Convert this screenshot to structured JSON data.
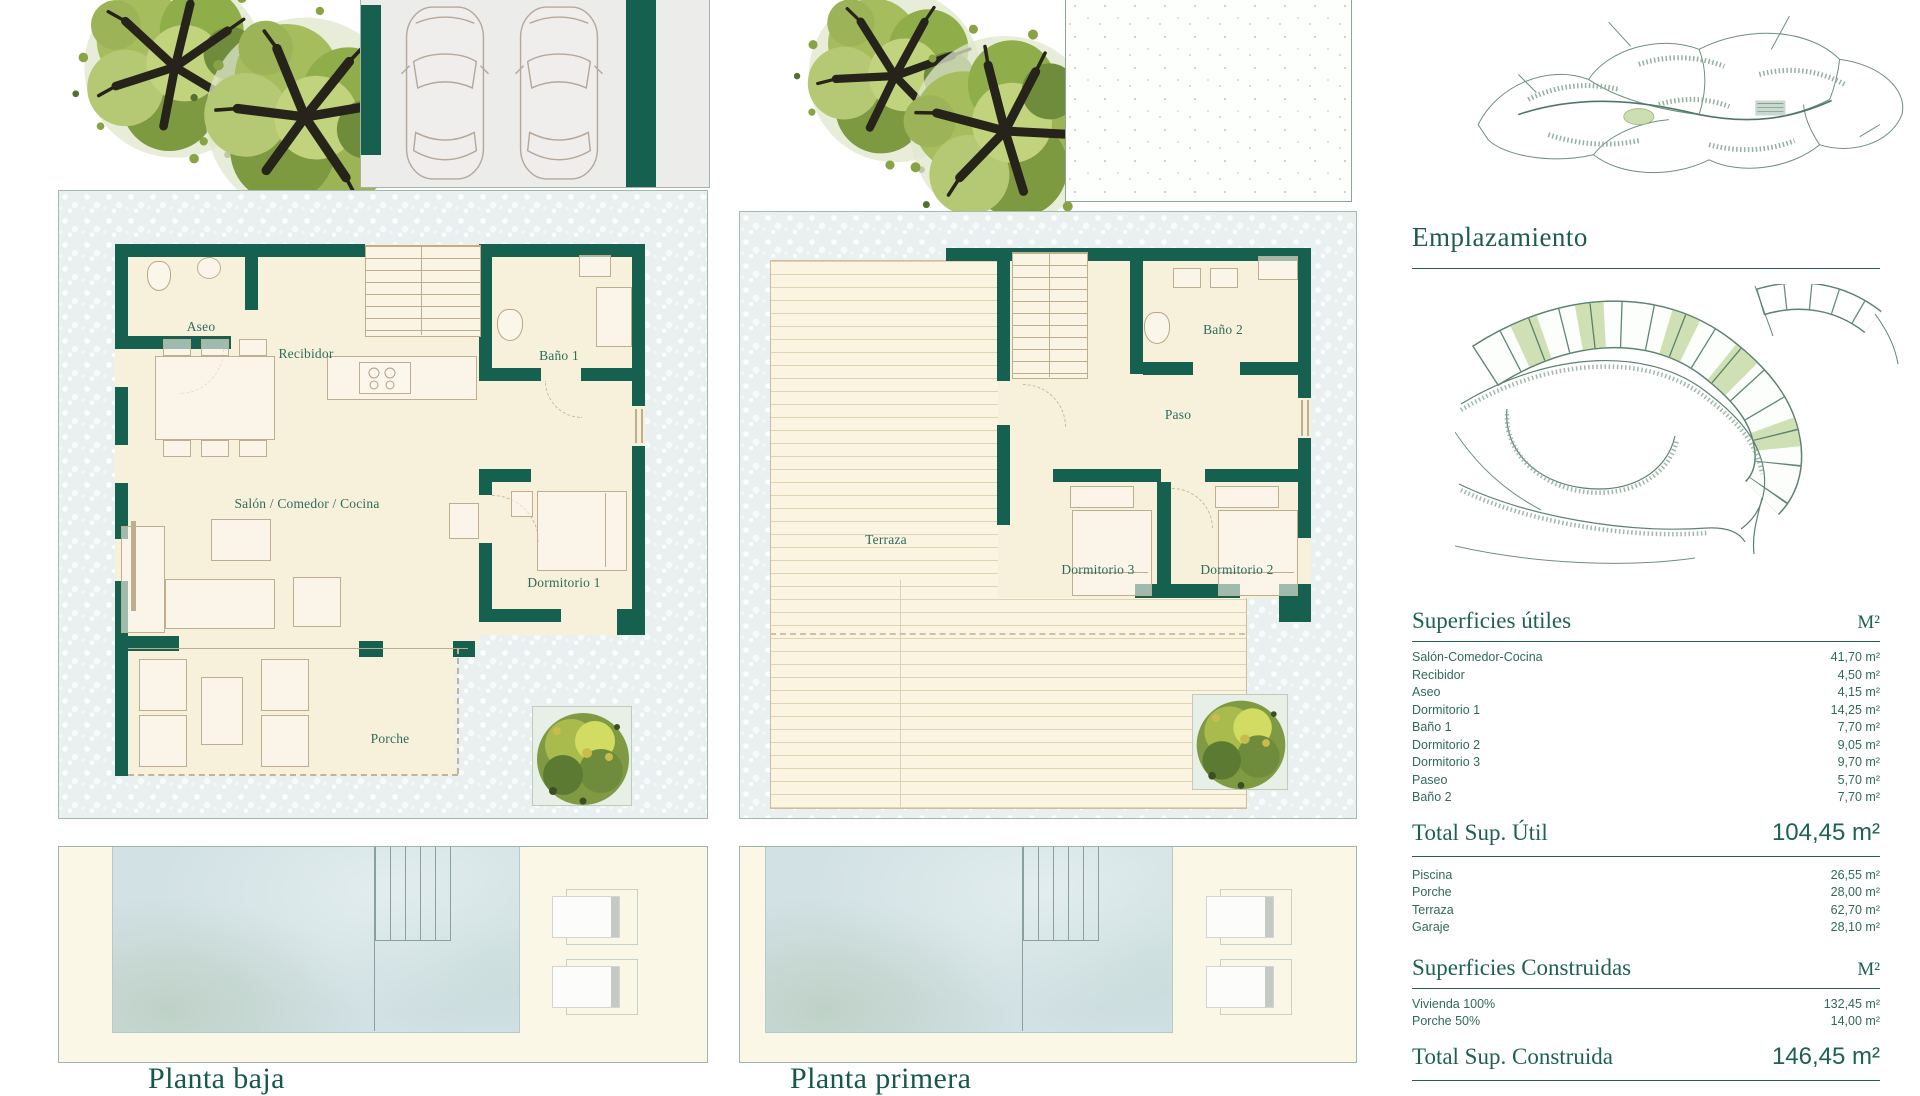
{
  "plans": {
    "ground": {
      "title": "Planta baja",
      "labels": {
        "aseo": "Aseo",
        "recibidor": "Recibidor",
        "bano1": "Baño 1",
        "salon": "Salón / Comedor / Cocina",
        "dormitorio1": "Dormitorio 1",
        "porche": "Porche"
      }
    },
    "upper": {
      "title": "Planta primera",
      "labels": {
        "terraza": "Terraza",
        "bano2": "Baño 2",
        "paso": "Paso",
        "dormitorio3": "Dormitorio 3",
        "dormitorio2": "Dormitorio 2"
      }
    }
  },
  "location": {
    "title": "Emplazamiento"
  },
  "surfaces": {
    "useful": {
      "title": "Superficies útiles",
      "unit": "M²",
      "rows": [
        {
          "label": "Salón-Comedor-Cocina",
          "value": "41,70 m²"
        },
        {
          "label": "Recibidor",
          "value": "4,50 m²"
        },
        {
          "label": "Aseo",
          "value": "4,15 m²"
        },
        {
          "label": "Dormitorio 1",
          "value": "14,25 m²"
        },
        {
          "label": "Baño 1",
          "value": "7,70 m²"
        },
        {
          "label": "Dormitorio 2",
          "value": "9,05 m²"
        },
        {
          "label": "Dormitorio 3",
          "value": "9,70 m²"
        },
        {
          "label": "Paseo",
          "value": "5,70 m²"
        },
        {
          "label": "Baño 2",
          "value": "7,70 m²"
        }
      ],
      "total": {
        "label": "Total Sup. Útil",
        "value": "104,45 m²"
      }
    },
    "outdoor_rows": [
      {
        "label": "Piscina",
        "value": "26,55 m²"
      },
      {
        "label": "Porche",
        "value": "28,00 m²"
      },
      {
        "label": "Terraza",
        "value": "62,70 m²"
      },
      {
        "label": "Garaje",
        "value": "28,10 m²"
      }
    ],
    "built": {
      "title": "Superficies Construidas",
      "unit": "M²",
      "rows": [
        {
          "label": "Vivienda 100%",
          "value": "132,45 m²"
        },
        {
          "label": "Porche 50%",
          "value": "14,00 m²"
        }
      ],
      "total": {
        "label": "Total Sup. Construida",
        "value": "146,45 m²"
      }
    }
  },
  "colors": {
    "wall": "#15604e",
    "accent": "#1e6152",
    "plot_highlight": "#cfe0b4"
  }
}
